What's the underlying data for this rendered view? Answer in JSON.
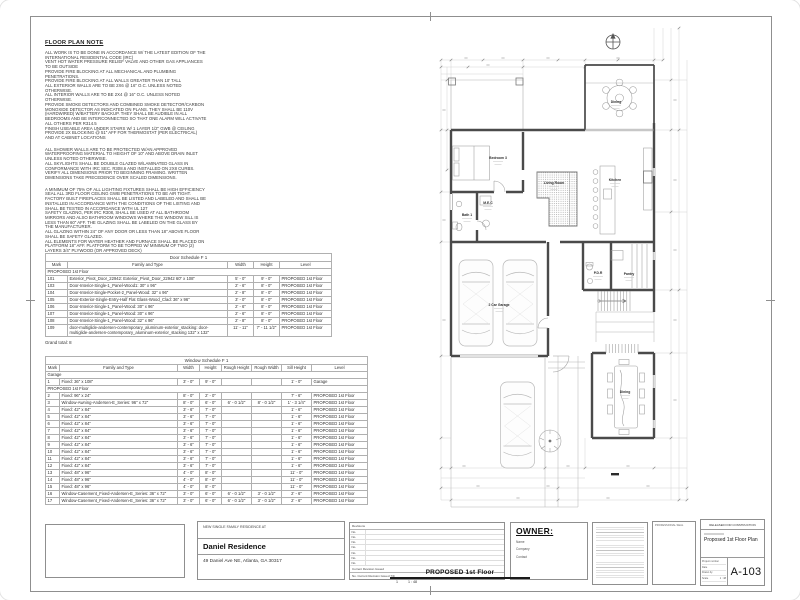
{
  "colors": {
    "ink": "#2b2b2b",
    "wall": "#4a4a4a",
    "dim_line": "#d2d2d2"
  },
  "notes": {
    "title": "FLOOR PLAN NOTE",
    "sections": [
      [
        "ALL WORK IS TO BE DONE IN ACCORDANCE W/ THE LATEST EDITION OF THE INTERNATIONAL RESIDENTIAL CODE (IRC)",
        "VENT HOT WATER PRESSURE RELIEF VALVE AND OTHER GAS APPLIANCES TO BE OUTSIDE",
        "PROVIDE FIRE BLOCKING AT ALL MECHANICAL AND PLUMBING PENETRATIONS.",
        "PROVIDE FIRE BLOCKING AT ALL WALLS GREATER THAN 10' TALL",
        "ALL EXTERIOR WALLS ARE TO BE 2X6 @ 16\" O.C. UNLESS NOTED OTHERWISE.",
        "ALL INTERIOR WALLS ARE TO BE 2X4 @ 16\" O.C. UNLESS NOTED OTHERWISE.",
        "PROVIDE SMOKE DETECTORS AND COMBINED SMOKE DETECTOR/CARBON MONOXIDE DETECTOR AS INDICATED ON PLANS. THEY SHALL BE 110V (HARDWIRED) W/BATTERY BACKUP. THEY SHALL BE AUDIBLE IN ALL BEDROOMS AND BE INTERCONNECTED SO THAT ONE ALARM WILL ACTIVATE ALL OTHERS PER R314.5",
        "FINISH USEABLE AREA UNDER STAIRS W/ 1 LAYER 1/2\" GWB @ CEILING",
        "PROVIDE 2X BLOCKING @ 51\" AFF FOR THERMOSTAT (PER ELECTRICAL) AND AT CABINET LOCATIONS"
      ],
      [
        "ALL SHOWER WALLS ARE TO BE PROTECTED W/AN APPROVED WATERPROOFING MATERIAL TO HEIGHT OF 10\" AND ABOVE DRAIN INLET UNLESS NOTED OTHERWISE.",
        "ALL SKYLIGHTS SHALL BE DOUBLE GLAZED W/LAMINATED GLASS IN CONFORMANCE WITH IRC SEC. R308.6 AND INSTALLED ON 2X8 CURBS.",
        "VERIFY ALL DIMENSIONS PRIOR TO BEGINNING FRAMING. WRITTEN DIMENSIONS TAKE PRECEDENCE OVER SCALED DIMENSIONS."
      ],
      [
        "A MINIMUM OF 75% OF ALL LIGHTING FIXTURES SHALL BE HIGH EFFICIENCY",
        "SEAL ALL 3RD FLOOR CEILING GWB PENETRATIONS TO BE AIR TIGHT.",
        "FACTORY BUILT FIREPLACES SHALL BE LISTED AND LABELED AND SHALL BE INSTALLED IN ACCORDANCE WITH THE CONDITIONS OF THE LISTING AND SHALL BE TESTED IN ACCORDANCE WITH UL 127",
        "SAFETY GLAZING, PER IRC R308, SHALL BE USED AT ALL BATHROOM MIRRORS AND ALSO BATHROOM WINDOWS WHERE THE WINDOW SILL IS LESS THAN 60\" AFF. THE GLAZING SHALL BE LABELED ON THE GLASS BY THE MANUFACTURER.",
        "ALL GLAZING WITHIN 24\" OF ANY DOOR OR LESS THAN 18\" ABOVE FLOOR SHALL BE SAFETY GLAZED.",
        "ALL ELEMENTS FOR WATER HEATHER AND FURNACE SHALL BE PLACED ON PLATFORM 18\" AFF. PLATFORM TO BE TOPPED W/ MINIMUM OF TWO (2) LAYERS 3/4\" PLYWOOD (OR APPROVED DECK)"
      ]
    ]
  },
  "door_schedule": {
    "title": "Door Schedule F 1",
    "columns": [
      "Mark",
      "Family and Type",
      "Width",
      "Height",
      "Level"
    ],
    "groups": [
      {
        "label": "PROPOSED 1st Floor",
        "rows": [
          [
            "101",
            "Exterior_Pivot_Door_22942: Exterior_Pivot_Door_22942 60\" x 108\"",
            "5' - 0\"",
            "9' - 0\"",
            "PROPOSED 1st Floor"
          ],
          [
            "103",
            "Door-Interior-Single-1_Panel-Wood1: 30\" x 96\"",
            "2' - 6\"",
            "8' - 0\"",
            "PROPOSED 1st Floor"
          ],
          [
            "104",
            "Door-Interior-Single-Pocket-2_Panel-Wood: 32\" x 96\"",
            "2' - 8\"",
            "8' - 0\"",
            "PROPOSED 1st Floor"
          ],
          [
            "105",
            "Door-Exterior-Single-Entry-Half Flat Glass-Wood_Clad: 36\" x 96\"",
            "3' - 0\"",
            "8' - 0\"",
            "PROPOSED 1st Floor"
          ],
          [
            "106",
            "Door-Interior-Single-1_Panel-Wood: 30\" x 96\"",
            "2' - 6\"",
            "8' - 0\"",
            "PROPOSED 1st Floor"
          ],
          [
            "107",
            "Door-Interior-Single-1_Panel-Wood: 30\" x 96\"",
            "2' - 6\"",
            "8' - 0\"",
            "PROPOSED 1st Floor"
          ],
          [
            "108",
            "Door-Interior-Single-1_Panel-Wood: 32\" x 96\"",
            "2' - 8\"",
            "8' - 0\"",
            "PROPOSED 1st Floor"
          ],
          [
            "109",
            "door-multiglide-andersen-contemporary_aluminum-exterior_stacking: door-multiglide-andersen-contemporary_aluminum-exterior_stacking 132\" x 132\"",
            "11' - 11\"",
            "7' - 11 1/2\"",
            "PROPOSED 1st Floor"
          ]
        ]
      }
    ],
    "footer": "Grand total: 8"
  },
  "window_schedule": {
    "title": "Window Schedule F 1",
    "columns": [
      "Mark",
      "Family and Type",
      "Width",
      "Height",
      "Rough Height",
      "Rough Width",
      "Sill Height",
      "Level"
    ],
    "groups": [
      {
        "label": "Garage",
        "rows": [
          [
            "1",
            "Fixed: 36\" x 108\"",
            "3' - 0\"",
            "9' - 0\"",
            "",
            "",
            "1' - 0\"",
            "Garage"
          ]
        ]
      },
      {
        "label": "PROPOSED 1st Floor",
        "rows": [
          [
            "2",
            "Fixed: 96\" x 24\"",
            "8' - 0\"",
            "2' - 0\"",
            "",
            "",
            "7' - 6\"",
            "PROPOSED 1st Floor"
          ],
          [
            "3",
            "Window-Awning-Andersen-E_Series: 96\" x 72\"",
            "8' - 0\"",
            "6' - 0\"",
            "6' - 0 1/2\"",
            "8' - 0 1/2\"",
            "1' - 3 1/4\"",
            "PROPOSED 1st Floor"
          ],
          [
            "4",
            "Fixed: 42\" x 84\"",
            "3' - 6\"",
            "7' - 0\"",
            "",
            "",
            "1' - 6\"",
            "PROPOSED 1st Floor"
          ],
          [
            "5",
            "Fixed: 42\" x 84\"",
            "3' - 6\"",
            "7' - 0\"",
            "",
            "",
            "1' - 6\"",
            "PROPOSED 1st Floor"
          ],
          [
            "6",
            "Fixed: 42\" x 84\"",
            "3' - 6\"",
            "7' - 0\"",
            "",
            "",
            "1' - 6\"",
            "PROPOSED 1st Floor"
          ],
          [
            "7",
            "Fixed: 42\" x 84\"",
            "3' - 6\"",
            "7' - 0\"",
            "",
            "",
            "1' - 6\"",
            "PROPOSED 1st Floor"
          ],
          [
            "8",
            "Fixed: 42\" x 84\"",
            "3' - 6\"",
            "7' - 0\"",
            "",
            "",
            "1' - 6\"",
            "PROPOSED 1st Floor"
          ],
          [
            "9",
            "Fixed: 42\" x 84\"",
            "3' - 6\"",
            "7' - 0\"",
            "",
            "",
            "1' - 6\"",
            "PROPOSED 1st Floor"
          ],
          [
            "10",
            "Fixed: 42\" x 84\"",
            "3' - 6\"",
            "7' - 0\"",
            "",
            "",
            "1' - 6\"",
            "PROPOSED 1st Floor"
          ],
          [
            "11",
            "Fixed: 42\" x 84\"",
            "3' - 6\"",
            "7' - 0\"",
            "",
            "",
            "1' - 6\"",
            "PROPOSED 1st Floor"
          ],
          [
            "12",
            "Fixed: 42\" x 84\"",
            "3' - 6\"",
            "7' - 0\"",
            "",
            "",
            "1' - 6\"",
            "PROPOSED 1st Floor"
          ],
          [
            "13",
            "Fixed: 48\" x 96\"",
            "4' - 0\"",
            "8' - 0\"",
            "",
            "",
            "11' - 0\"",
            "PROPOSED 1st Floor"
          ],
          [
            "14",
            "Fixed: 48\" x 96\"",
            "4' - 0\"",
            "8' - 0\"",
            "",
            "",
            "11' - 0\"",
            "PROPOSED 1st Floor"
          ],
          [
            "15",
            "Fixed: 48\" x 96\"",
            "4' - 0\"",
            "8' - 0\"",
            "",
            "",
            "11' - 0\"",
            "PROPOSED 1st Floor"
          ],
          [
            "16",
            "Window-Casement_Fixed-Andersen-E_Series: 36\" x 72\"",
            "3' - 0\"",
            "6' - 0\"",
            "6' - 0 1/2\"",
            "3' - 0 1/2\"",
            "2' - 6\"",
            "PROPOSED 1st Floor"
          ],
          [
            "17",
            "Window-Casement_Fixed-Andersen-E_Series: 36\" x 72\"",
            "3' - 0\"",
            "6' - 0\"",
            "6' - 0 1/2\"",
            "3' - 0 1/2\"",
            "2' - 6\"",
            "PROPOSED 1st Floor"
          ]
        ]
      }
    ]
  },
  "plan": {
    "rooms": [
      {
        "label": "Dining",
        "x": 188,
        "y": 83
      },
      {
        "label": "Bedroom 3",
        "x": 70,
        "y": 139
      },
      {
        "label": "M.E.C",
        "x": 60,
        "y": 184
      },
      {
        "label": "Bath 1",
        "x": 39,
        "y": 196
      },
      {
        "label": "Living Room",
        "x": 126,
        "y": 164
      },
      {
        "label": "Kitchen",
        "x": 187,
        "y": 161
      },
      {
        "label": "2 Car Garage",
        "x": 71,
        "y": 286
      },
      {
        "label": "P.D.R",
        "x": 170,
        "y": 254
      },
      {
        "label": "Pantry",
        "x": 201,
        "y": 255
      },
      {
        "label": "Dining",
        "x": 197,
        "y": 373
      }
    ]
  },
  "titleblock": {
    "project": {
      "intro": "NEW SINGLE FAMILY RESIDENCE AT",
      "name": "Daniel Residence",
      "address": "49 Daniel Ave NE, Atlanta, GA 30317"
    },
    "revisions": {
      "header": "Revisions",
      "no_label": "No.",
      "empty_rows": 7,
      "current_label": "Current Revision Issued",
      "issued_row": "No.    Current Revision Issued    7/9"
    },
    "owner": {
      "label": "OWNER:",
      "fields": [
        "Name",
        "Company",
        "Contact"
      ]
    },
    "seal_label": "PROFESSIONAL SEAL",
    "sheet": {
      "released": "RELEASED FOR CONSTRUCTION",
      "name": "Proposed 1st Floor Plan",
      "number": "A-103",
      "info_rows": [
        {
          "label": "Project number",
          "value": ""
        },
        {
          "label": "Date",
          "value": ""
        },
        {
          "label": "Drawn by",
          "value": ""
        },
        {
          "label": "Scale",
          "value": "1 : 48"
        }
      ]
    }
  },
  "view_title": {
    "number": "1",
    "label": "PROPOSED 1st Floor",
    "scale": "1 : 48"
  }
}
